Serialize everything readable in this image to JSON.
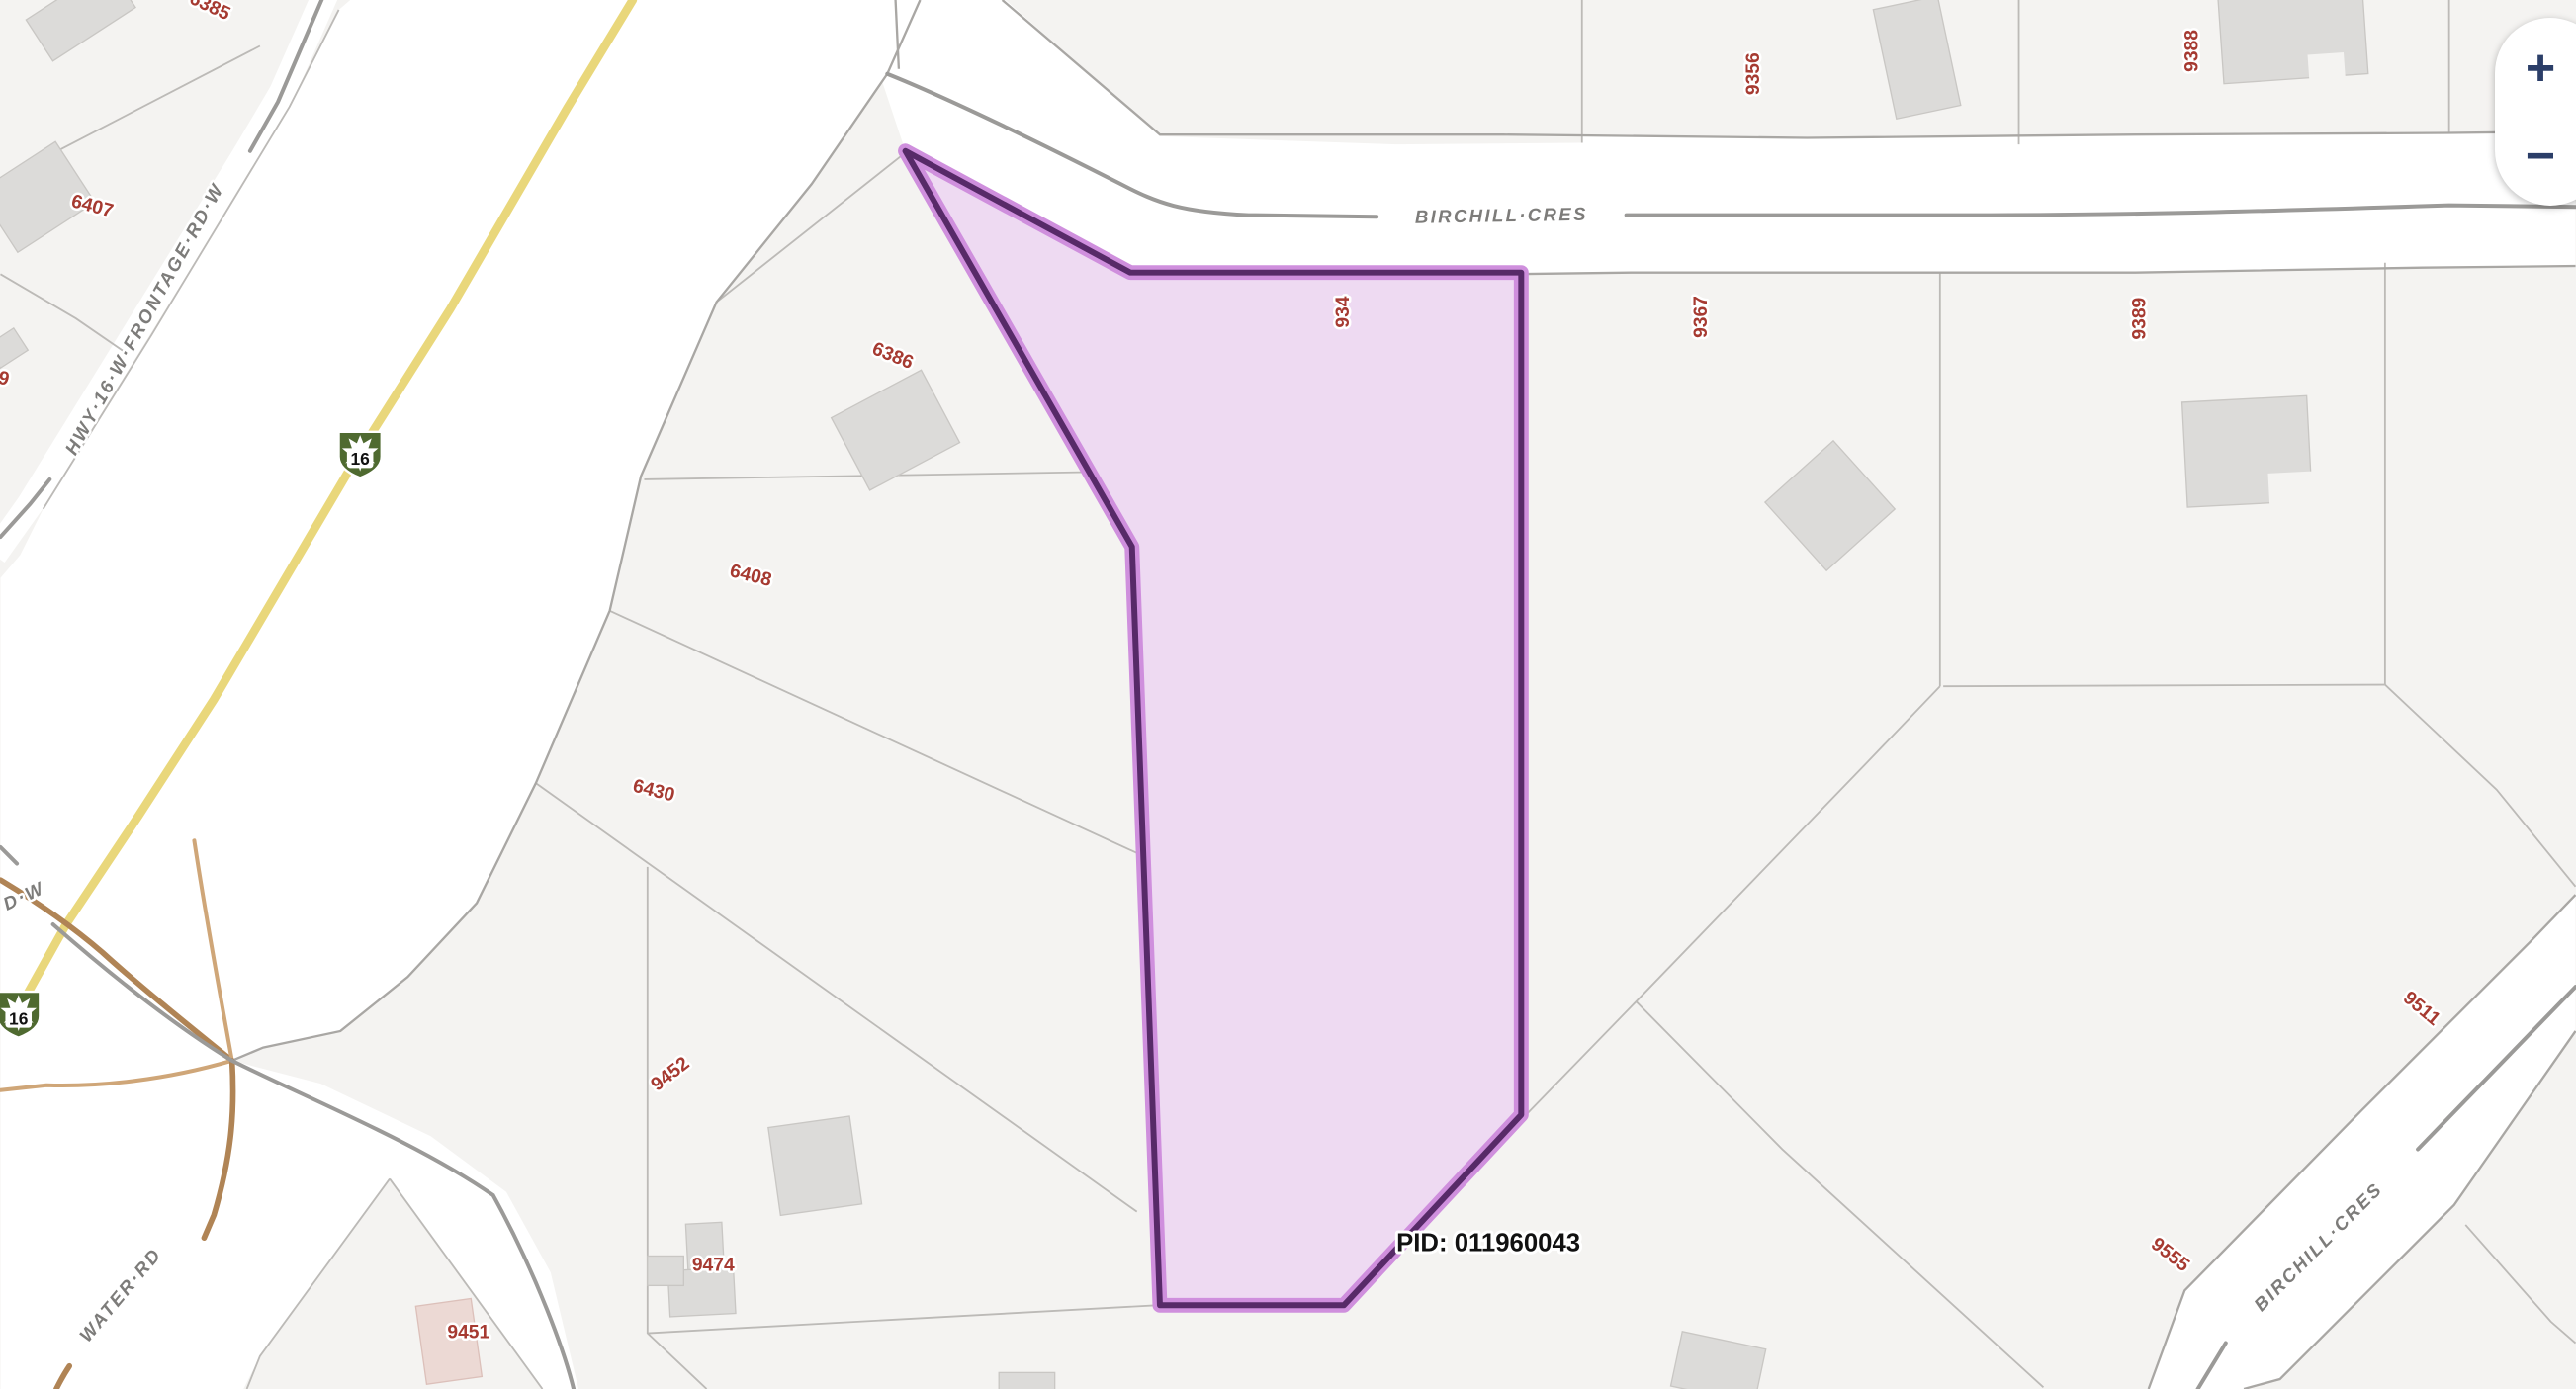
{
  "colors": {
    "parcel_bg": "#f4f3f1",
    "road_fill": "#ffffff",
    "parcel_line": "#bcbab7",
    "road_edge": "#a9a7a4",
    "centerline": "#9b9a98",
    "highway_yellow": "#e9d77b",
    "ramp_brown": "#b08455",
    "ramp_tan": "#cfa678",
    "building_fill": "#dcdbd9",
    "building_stroke": "#c9c7c4",
    "building_pink": "#ecd9d4",
    "building_pink_stroke": "#dcc0ba",
    "parcel_label": "#a63a31",
    "road_label": "#7d7c7a",
    "pid_text": "#111111",
    "highlight_fill": "#eedaf2",
    "highlight_light": "#cf8fdd",
    "highlight_dark": "#572a68",
    "shield_green": "#4f6a30",
    "zoom_icon": "#2b3e68",
    "halo": "#ffffff"
  },
  "map": {
    "pid_label": "PID: 011960043",
    "selected_boundary_number": "934",
    "shield_number": "16",
    "road_names": {
      "birchill_top": "BIRCHILL·CRES",
      "birchill_se": "BIRCHILL·CRES",
      "frontage": "HWY·16·W·FRONTAGE·RD·W",
      "dw": "D·W",
      "water": "WATER·RD"
    },
    "parcel_numbers": {
      "p6385": "6385",
      "p6407": "6407",
      "p9_partial": "9",
      "p6386": "6386",
      "p6408": "6408",
      "p6430": "6430",
      "p9452": "9452",
      "p9474": "9474",
      "p9451": "9451",
      "p9356": "9356",
      "p9388": "9388",
      "p9367": "9367",
      "p9389": "9389",
      "p9511": "9511",
      "p9555": "9555"
    }
  },
  "controls": {
    "zoom_in": "+",
    "zoom_out": "−"
  }
}
